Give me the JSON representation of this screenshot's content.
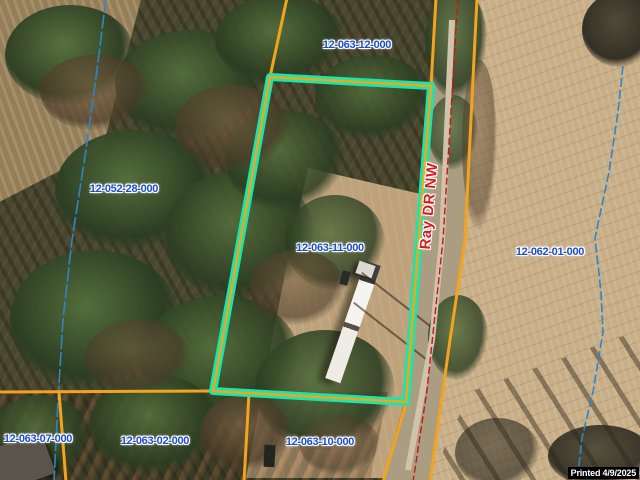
{
  "map": {
    "parcels": [
      {
        "id": "12-063-12-000"
      },
      {
        "id": "12-052-28-000"
      },
      {
        "id": "12-063-11-000"
      },
      {
        "id": "12-062-01-000"
      },
      {
        "id": "12-063-07-000"
      },
      {
        "id": "12-063-02-000"
      },
      {
        "id": "12-063-10-000"
      }
    ],
    "selected_parcel_id": "12-063-11-000",
    "road": {
      "name": "Ray DR NW"
    },
    "printed": {
      "text": "Printed 4/9/2025"
    },
    "colors": {
      "parcel_line": "#F2A41F",
      "selected_highlight": "#17E7AE",
      "road_centerline": "#CC1414",
      "stream_line": "#2E86C4",
      "parcel_label_text": "#1D4ECC",
      "road_label_text": "#D41F1F",
      "printed_bg": "#000000",
      "printed_text": "#FFFFFF"
    }
  }
}
